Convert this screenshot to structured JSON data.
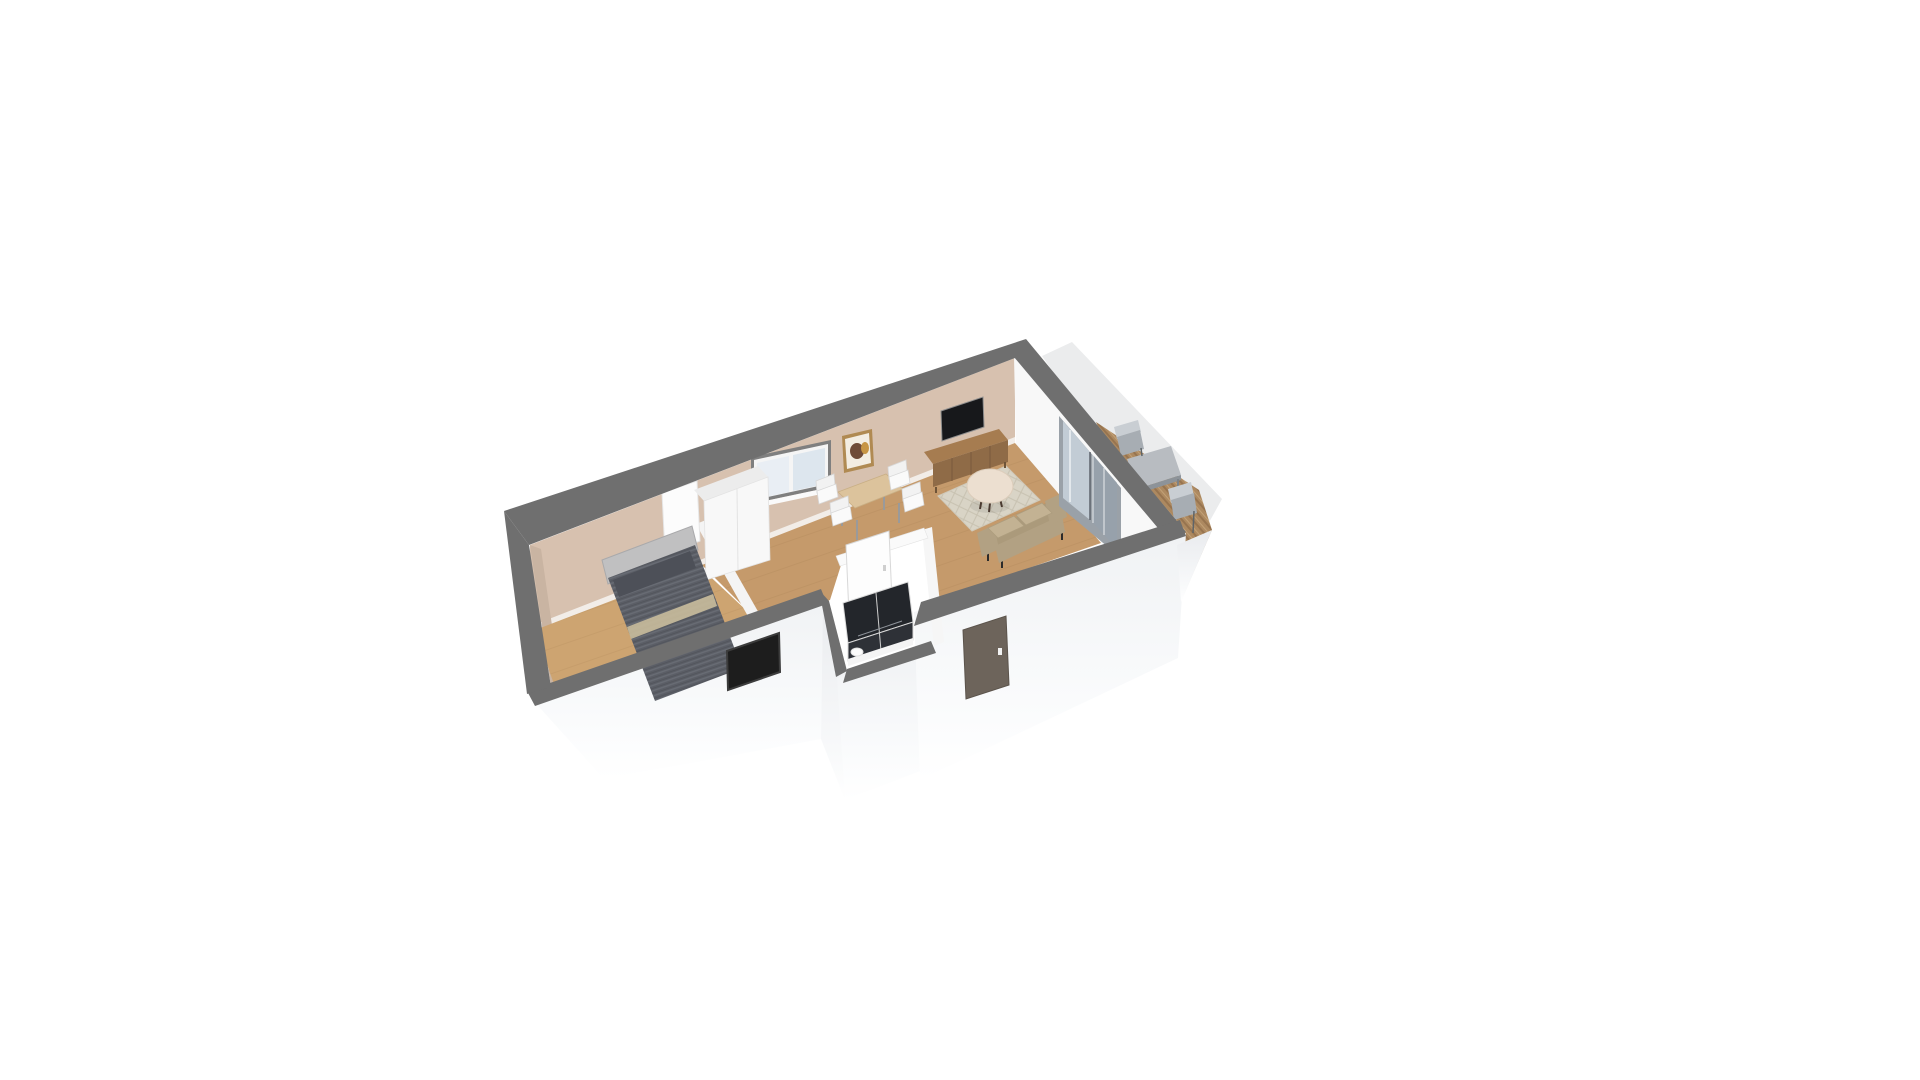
{
  "scene": {
    "view_mode": "3d",
    "background": "#ffffff",
    "object_names": [
      "bedroom-bed",
      "wardrobe",
      "bedroom-door-panel",
      "dining-table",
      "dining-chair",
      "tv-screen",
      "sideboard",
      "wall-art",
      "back-window",
      "area-rug",
      "round-coffee-table",
      "sofa",
      "sliding-glass-door",
      "bathroom-door",
      "shower-enclosure",
      "toilet",
      "entry-door",
      "bedroom-front-window",
      "deck-floor",
      "outdoor-table",
      "outdoor-chair"
    ]
  },
  "colors": {
    "page_bg": "#ffffff",
    "wall_top": "#6f6f6f",
    "wall_beige": "#d7c1af",
    "wall_beige_shade": "#c9b4a2",
    "baseboard": "#f2ede8",
    "white_wall": "#f8f8f8",
    "white_wall_top": "#ececec",
    "floor_living": "#c59a6b",
    "floor_bedroom": "#cda471",
    "backdrop_panel": "#ebeced",
    "deck_plank": "#ad8960",
    "glass_frame": "#9aa1a8",
    "glass_pane_light": "#c7d0d9",
    "glass_pane_dark": "#97a1ab",
    "window_glass_a": "#e9eef4",
    "window_glass_b": "#dde6ee",
    "window_frame": "#7f7f7f",
    "tv_screen": "#17181b",
    "entry_door": "#6d645b",
    "window_dark": "#1d1d1d",
    "sideboard_top": "#a67c50",
    "sideboard_front": "#8f6b47",
    "dining_table_wood": "#dcc39c",
    "chair_white": "#f2f2f2",
    "sofa_body": "#ab9a7b",
    "sofa_arm": "#b2a183",
    "sofa_cushion": "#c3b293",
    "rug": "#d9d4c6",
    "round_table": "#ecdfd0",
    "bed_headboard": "#c0c0c1",
    "bed_duvet": "#5b5e66",
    "bed_pillow": "#4d5058",
    "bed_throw": "#c9bc9c",
    "shower_glass": "#23262b",
    "shower_glass_front": "#2e3137",
    "bathroom_door": "#fdfdfd",
    "outdoor_table": "#b8bcc1",
    "outdoor_chair_seat": "#a7adb3",
    "outdoor_chair_back": "#c9ced3"
  }
}
